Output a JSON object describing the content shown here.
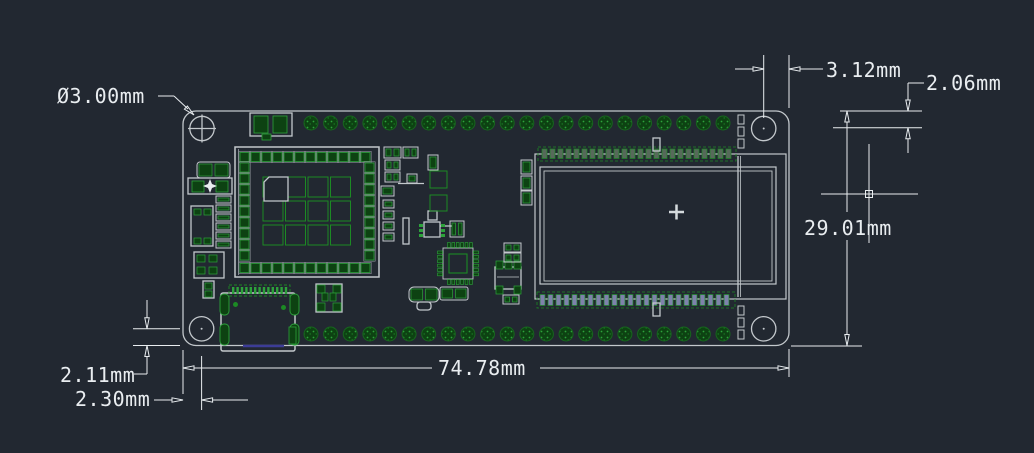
{
  "drawing": {
    "type": "pcb-dimension-drawing",
    "units": "mm",
    "dimensions": {
      "hole_diameter": "Ø3.00mm",
      "hole_to_right_edge": "3.12mm",
      "top_edge_to_hole": "2.06mm",
      "board_height": "29.01mm",
      "board_width": "74.78mm",
      "hole_to_bottom_edge": "2.11mm",
      "left_edge_to_hole": "2.30mm"
    },
    "board": {
      "pin_pads_per_row": 22,
      "mounting_holes": 4,
      "display_connector_pads": 24
    },
    "colors": {
      "background": "#222831",
      "outline_gray": "#c3c8cc",
      "dimension_white": "#e9edf0",
      "pad_green_dark": "#0d4212",
      "pad_green_bright": "#2da23b",
      "silk_green": "#1c8a24",
      "connector_blue": "#7e82ab",
      "usb_purple": "#3c3c96"
    }
  }
}
